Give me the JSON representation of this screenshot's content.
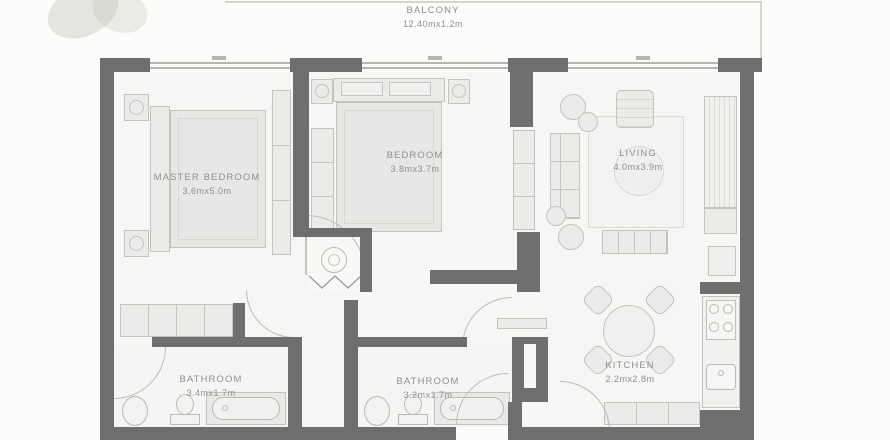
{
  "plan": {
    "balcony": {
      "label": "BALCONY",
      "dims": "12.40mx1.2m"
    },
    "rooms": [
      {
        "key": "master-bedroom",
        "label": "MASTER BEDROOM",
        "dims": "3.6mx5.0m"
      },
      {
        "key": "bedroom",
        "label": "BEDROOM",
        "dims": "3.8mx3.7m"
      },
      {
        "key": "living",
        "label": "LIVING",
        "dims": "4.0mx3.9m"
      },
      {
        "key": "kitchen",
        "label": "KITCHEN",
        "dims": "2.2mx2.8m"
      },
      {
        "key": "bathroom-1",
        "label": "BATHROOM",
        "dims": "3.4mx1.7m"
      },
      {
        "key": "bathroom-2",
        "label": "BATHROOM",
        "dims": "3.2mx1.7m"
      }
    ],
    "colors": {
      "wall": "#6e6e6e",
      "floor": "#f6f6f4",
      "furniture": "#ebebe9",
      "furniture_border": "#c3c3c0",
      "door_arc": "#bcbcb9",
      "label_text": "#8f8f8f",
      "window_line": "#b5b5b2",
      "decor_green": "#bcc5b4"
    }
  }
}
